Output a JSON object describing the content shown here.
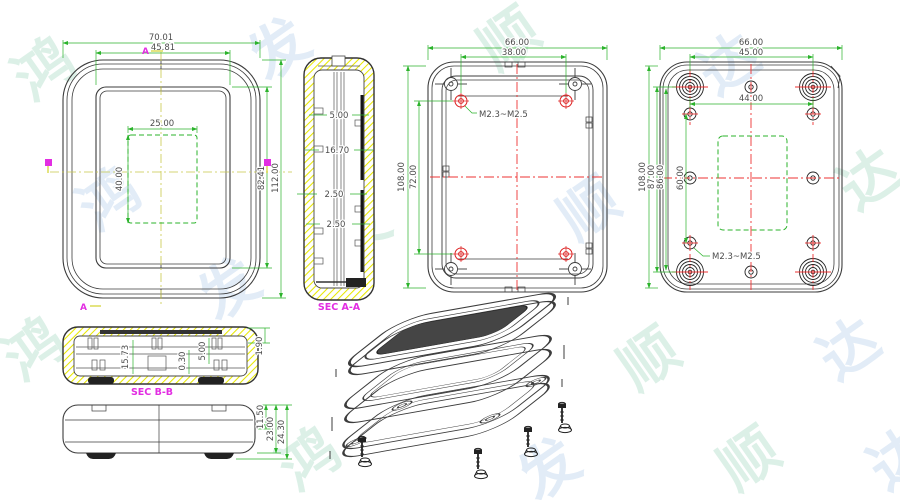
{
  "watermark": {
    "chars": [
      "鸿",
      "发",
      "顺",
      "达",
      "鸿",
      "发",
      "顺",
      "达",
      "鸿",
      "发",
      "顺",
      "达",
      "鸿",
      "发",
      "顺",
      "达"
    ]
  },
  "drawing": {
    "front": {
      "dim_outer_width": "70.01",
      "dim_bezel_width": "45.81",
      "dim_cutout_width": "25.00",
      "dim_cutout_height": "40.00",
      "dim_bezel_height": "82.41",
      "dim_outer_height": "112.00",
      "marker_a": "A"
    },
    "sec_aa": {
      "label": "SEC A-A",
      "dim_1": "5.00",
      "dim_2": "16.70",
      "dim_3": "2.50",
      "dim_4": "2.50"
    },
    "inner_bottom": {
      "dim_width": "66.00",
      "dim_boss_width": "38.00",
      "dim_height": "108.00",
      "dim_boss_height": "72.00",
      "thread": "M2.3~M2.5"
    },
    "outer_bottom": {
      "dim_width": "66.00",
      "dim_foot_width": "45.00",
      "dim_hole_width": "44.00",
      "dim_height": "108.00",
      "dim_87": "87.00",
      "dim_86": "86.00",
      "dim_60": "60.00",
      "thread": "M2.3~M2.5"
    },
    "sec_bb": {
      "label": "SEC B-B",
      "dim_1": "15.73",
      "dim_2": "0.30",
      "dim_3": "5.00",
      "dim_4": "1.90"
    },
    "side": {
      "dim_1": "11.50",
      "dim_2": "23.00",
      "dim_3": "24.30"
    }
  }
}
